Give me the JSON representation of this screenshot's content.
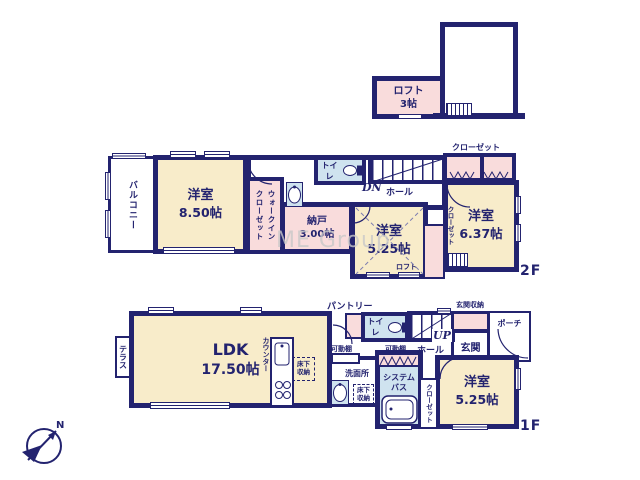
{
  "colors": {
    "wall": "#23236f",
    "cream": "#f8ecca",
    "pink": "#f9dcdc",
    "blue": "#cfe3ef",
    "wm": "#c9c9c9"
  },
  "watermark": "ME Group",
  "compass": {
    "north": "N"
  },
  "loft_floor": {
    "loft": {
      "name": "ロフト",
      "size": "3帖"
    }
  },
  "floor2": {
    "label": "2F",
    "balcony": "バルコニー",
    "bedroom_850": {
      "name": "洋室",
      "size": "8.50帖"
    },
    "wic": {
      "line1": "ウォークイン",
      "line2": "クローゼット"
    },
    "toilet": "トイレ",
    "stairs_dn": "DN",
    "hall": "ホール",
    "storeroom": {
      "name": "納戸",
      "size": "3.00帖"
    },
    "bedroom_525": {
      "name": "洋室",
      "size": "5.25帖"
    },
    "loft_note": "ロフト",
    "closet_side": "クローゼット",
    "closet_top": "クローゼット",
    "bedroom_637": {
      "name": "洋室",
      "size": "6.37帖"
    }
  },
  "floor1": {
    "label": "1F",
    "terrace": "テラス",
    "ldk": {
      "name": "LDK",
      "size": "17.50帖"
    },
    "counter": "カウンター",
    "underfloor_ldk": {
      "line1": "床下",
      "line2": "収納"
    },
    "pantry": "パントリー",
    "toilet": "トイレ",
    "stairs_up": "UP",
    "hall": "ホール",
    "shelf_left": "可動棚",
    "shelf_right": "可動棚",
    "washroom": "洗面所",
    "underfloor_wash": {
      "line1": "床下",
      "line2": "収納"
    },
    "bath": {
      "line1": "システム",
      "line2": "バス"
    },
    "entrance_storage": "玄関収納",
    "entrance": "玄関",
    "porch": "ポーチ",
    "closet": "クローゼット",
    "bedroom_525": {
      "name": "洋室",
      "size": "5.25帖"
    }
  }
}
